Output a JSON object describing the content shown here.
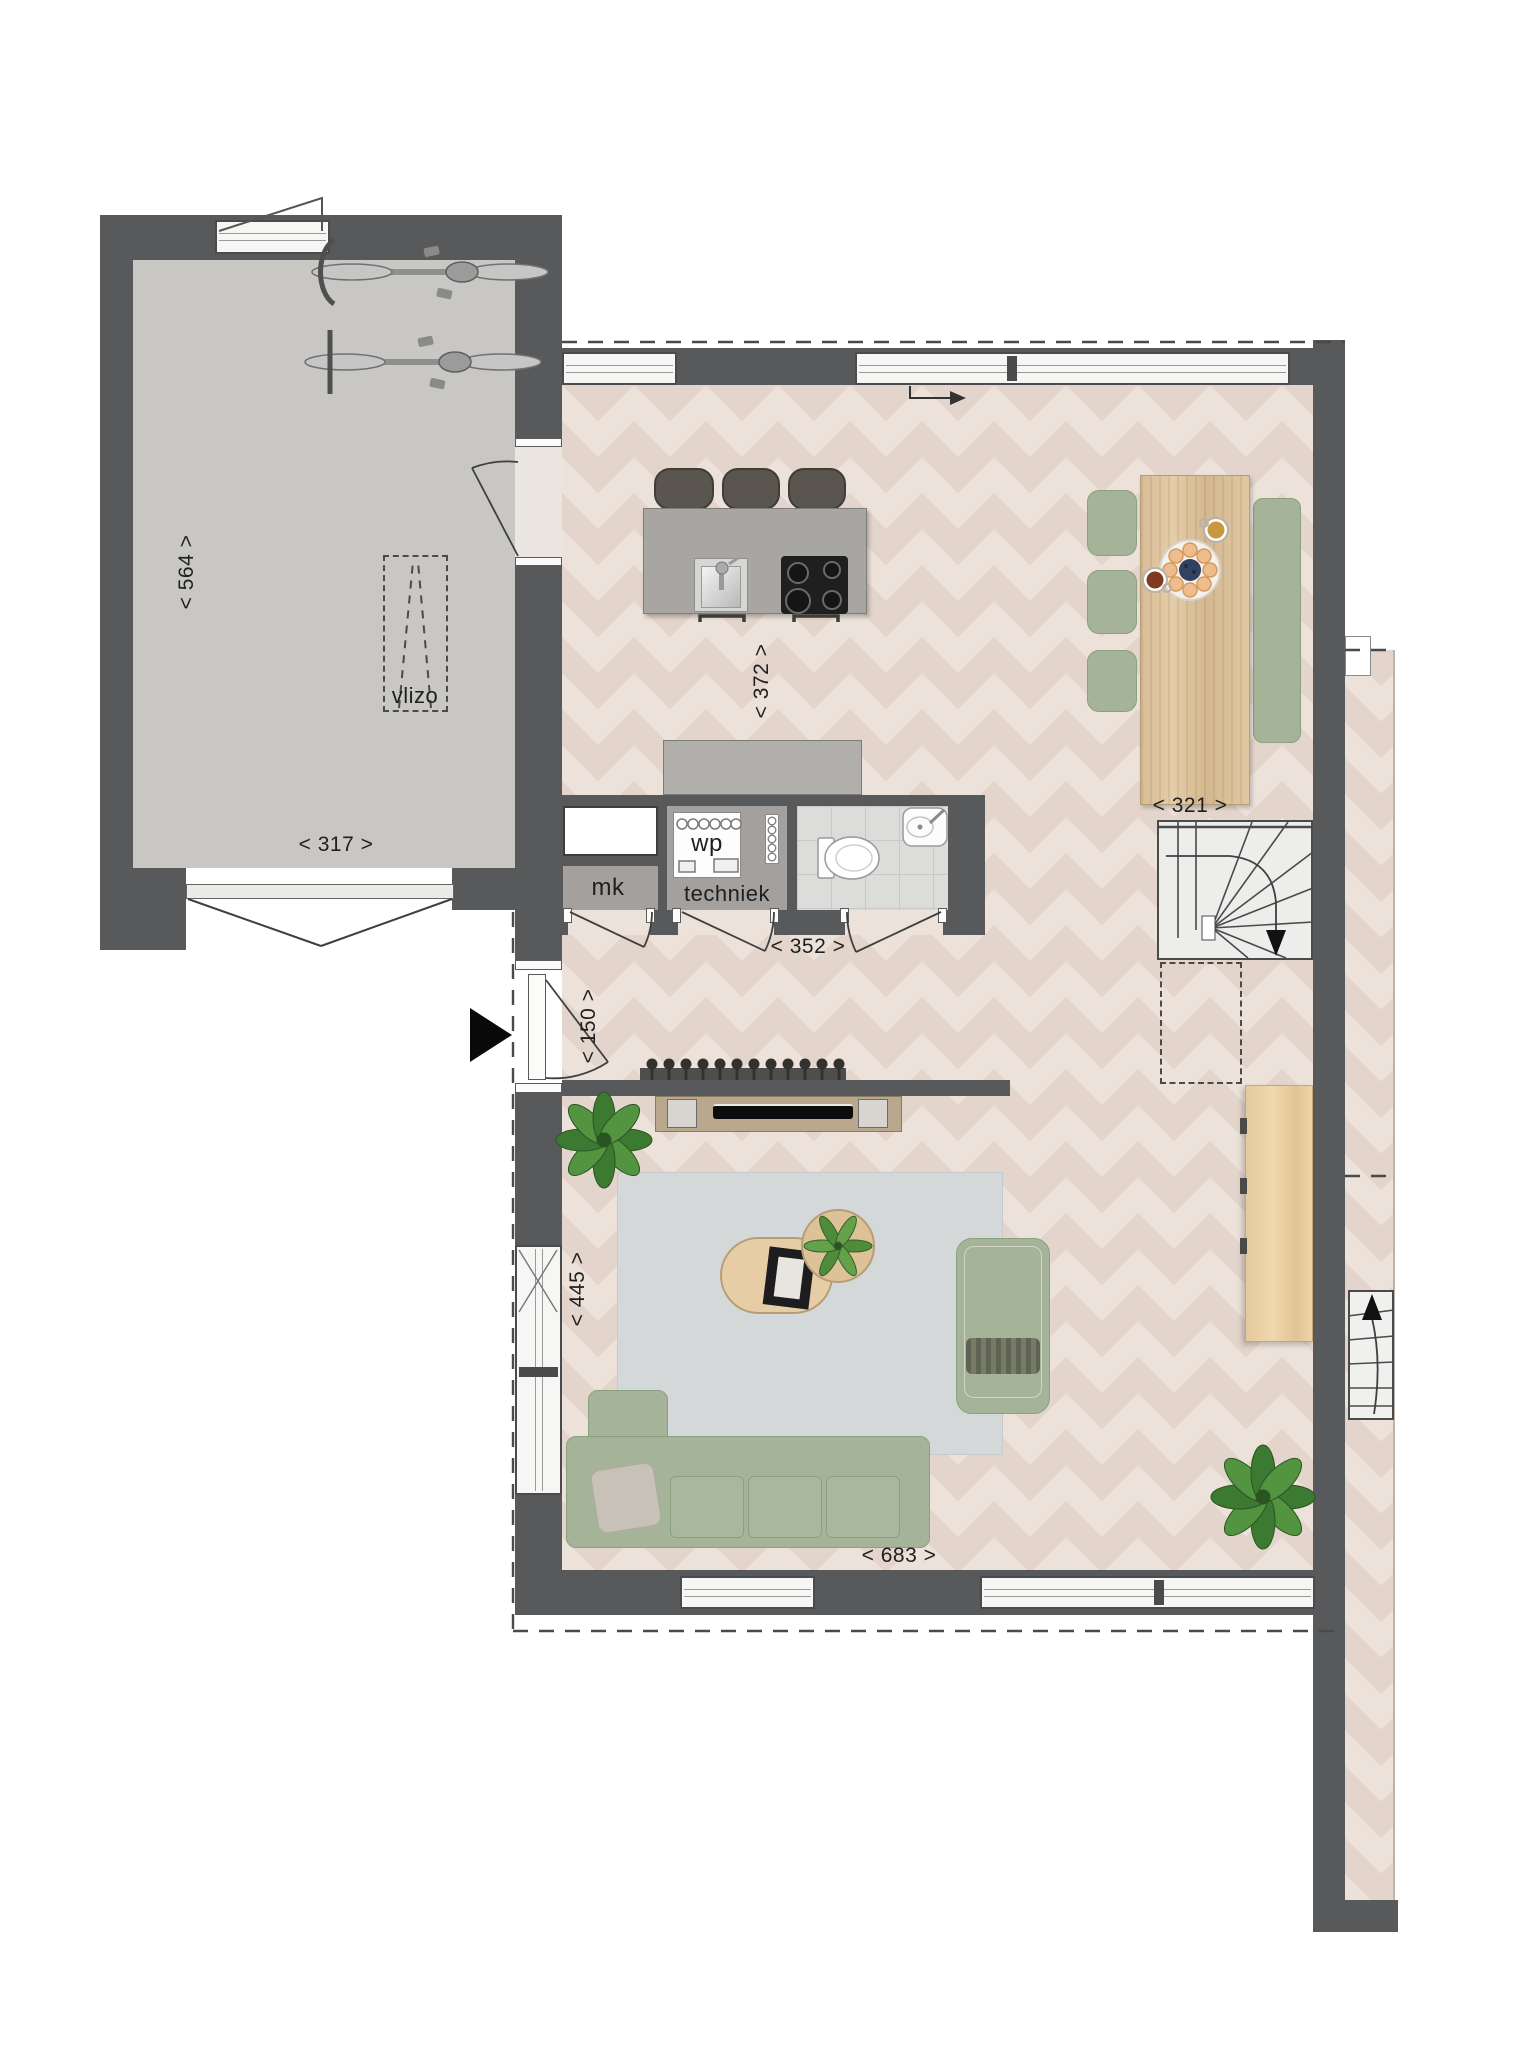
{
  "labels": {
    "vlizo": "vlizo",
    "mk": "mk",
    "wp": "wp",
    "techniek": "techniek"
  },
  "dimensions": {
    "garage_depth": "< 564 >",
    "garage_width": "< 317 >",
    "kitchen": "< 372 >",
    "utility": "< 352 >",
    "stairs": "< 321 >",
    "entry": "< 150 >",
    "living_depth": "< 445 >",
    "living_width": "< 683 >"
  },
  "icons": {
    "entry-arrow-icon": "▶",
    "stairs-down-arrow-icon": "▼",
    "stairs-up-arrow-icon": "▲",
    "window-direction-arrow-icon": "→"
  },
  "colors": {
    "wall": "#58595b",
    "garage_floor": "#c9c7c4",
    "wood_floor": "#ece2da",
    "wood_floor_accent": "#e3d5cb",
    "rug": "#d5d8d9",
    "kitchen_island": "#a8a6a2",
    "cabinet": "#b1afac",
    "sofa_green": "#a5b499",
    "wood_furniture": "#dcc09b",
    "fireplace_surround": "#b9a88e",
    "tile_floor": "#dcdcda",
    "utility_floor": "#a3a09d",
    "dash_line": "#4a4a4a",
    "plant_green": "#477f35"
  }
}
